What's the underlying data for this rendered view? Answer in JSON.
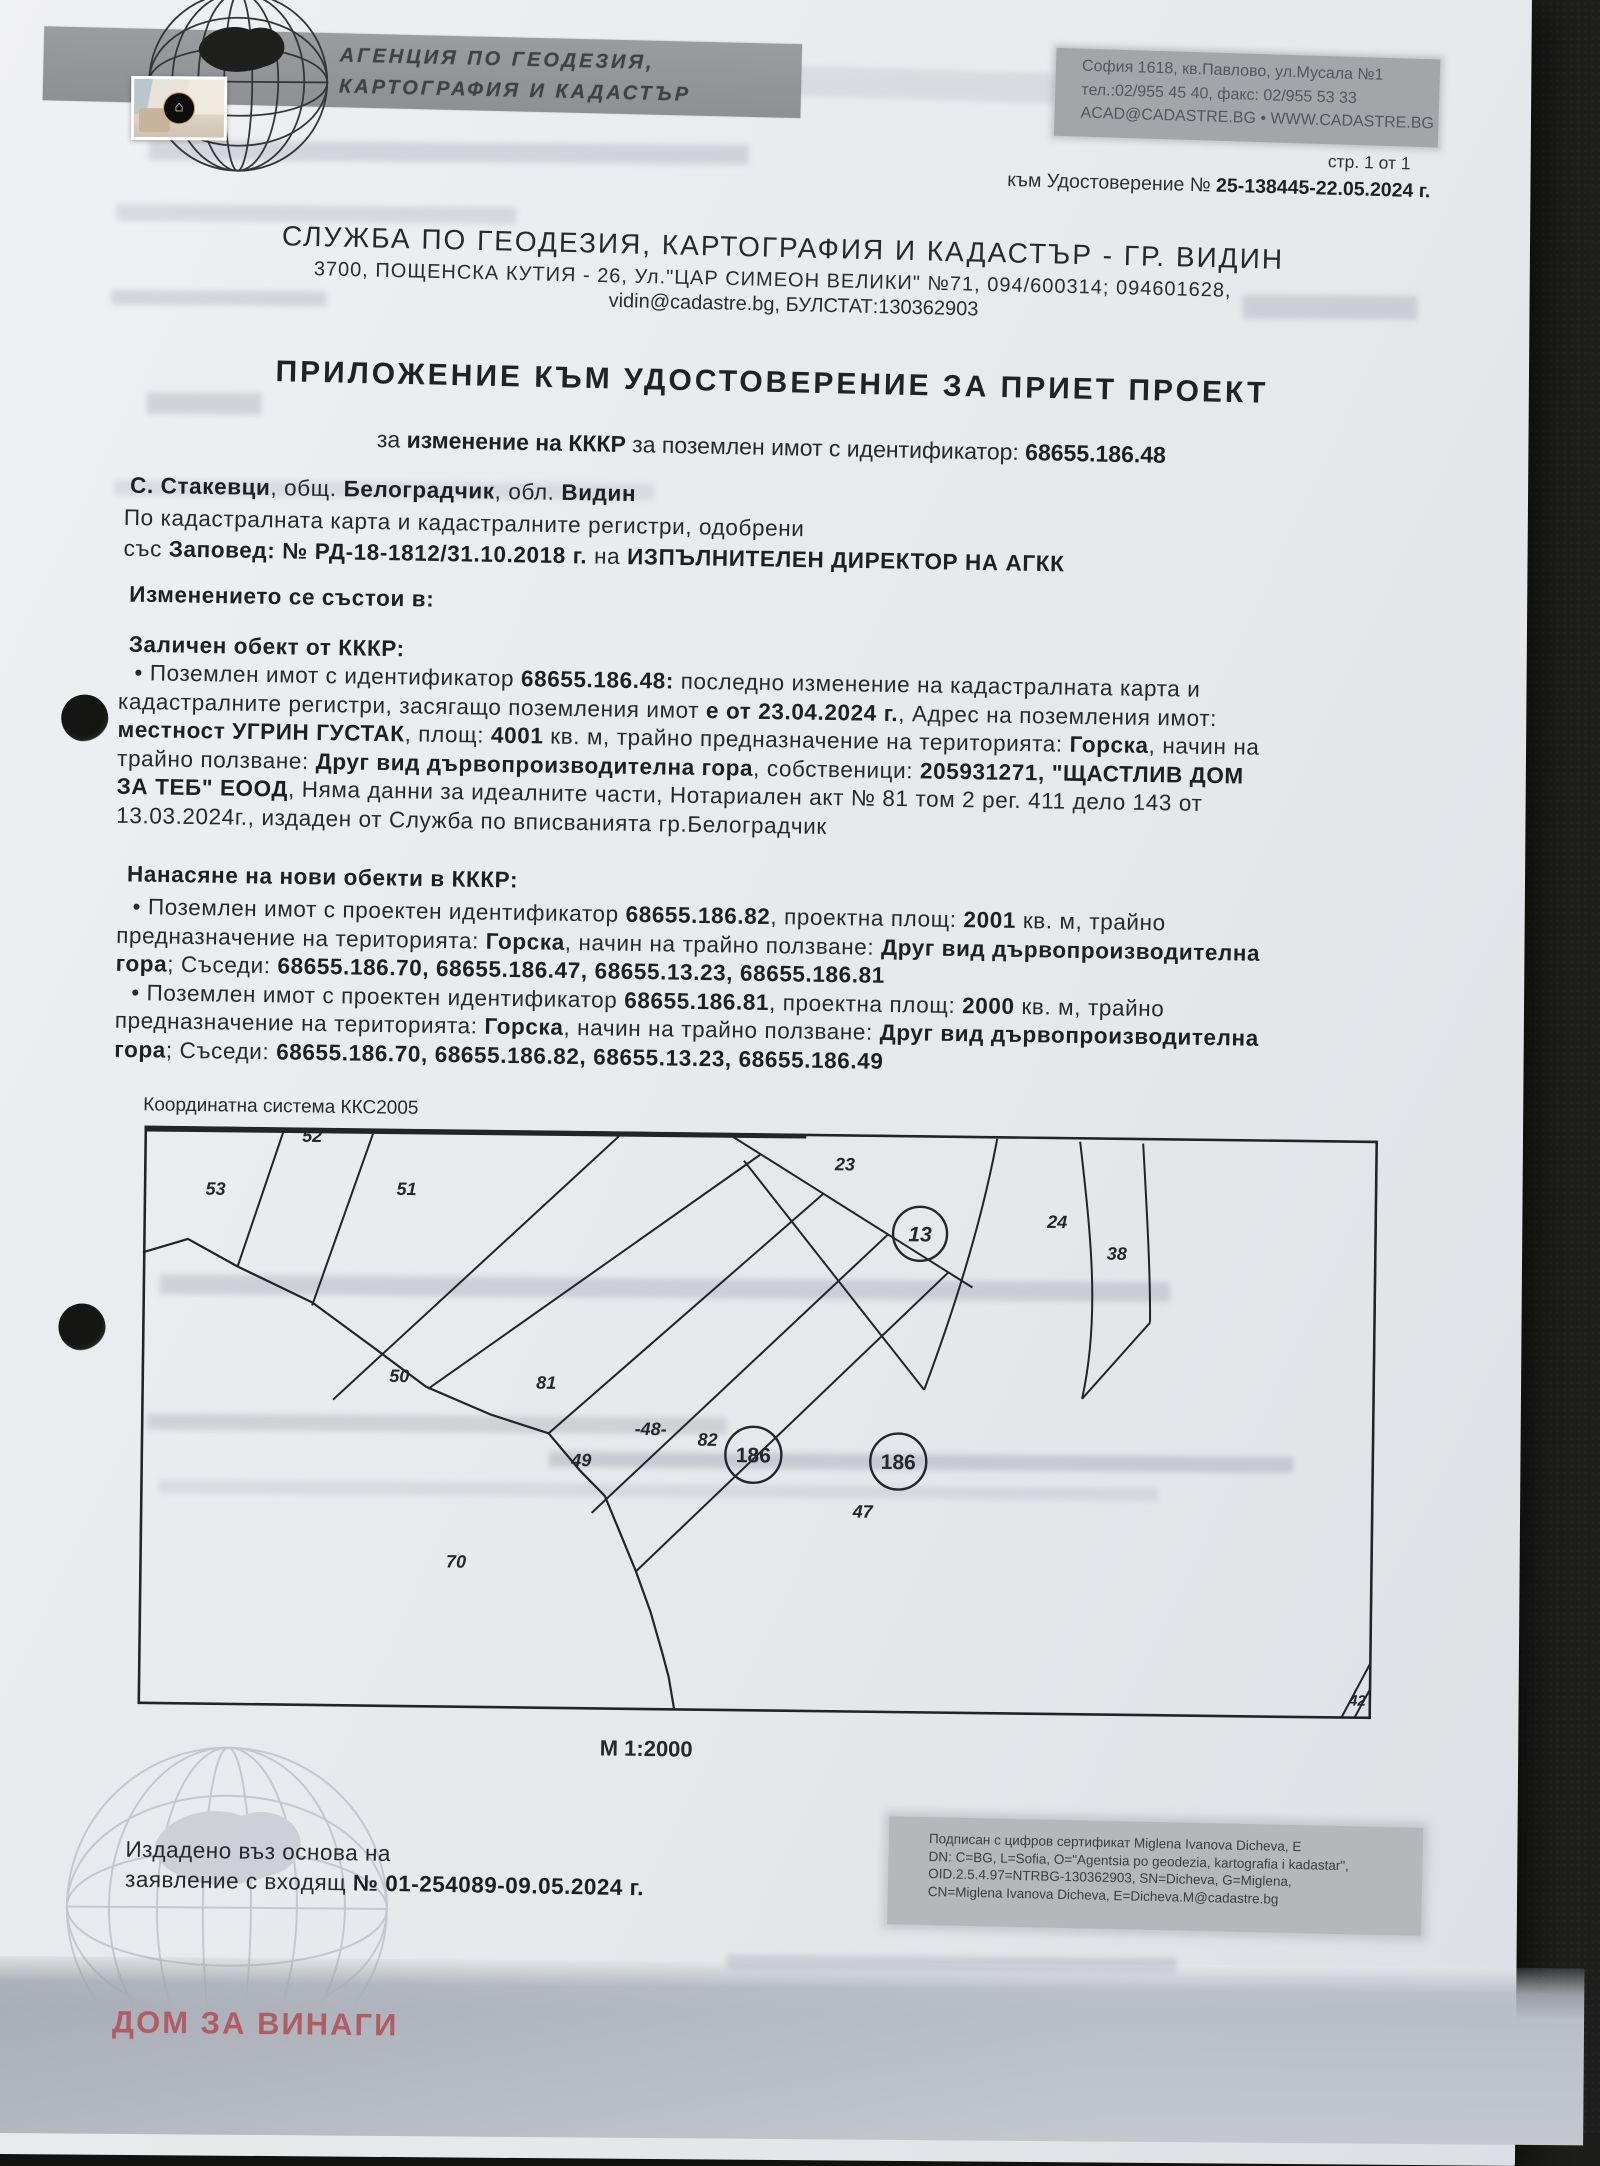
{
  "meta": {
    "page_note": "стр. 1 от 1",
    "cert_ref_label": "към Удостоверение № ",
    "cert_ref_number": "25-138445-22.05.2024 г."
  },
  "agency": {
    "name_line1": "АГЕНЦИЯ ПО ГЕОДЕЗИЯ,",
    "name_line2": "КАРТОГРАФИЯ И КАДАСТЪР",
    "hq_address": "София 1618, кв.Павлово, ул.Мусала №1",
    "hq_phone": "тел.:02/955 45 40, факс: 02/955 53 33",
    "hq_web": "ACAD@CADASTRE.BG • WWW.CADASTRE.BG",
    "logo_icon": "globe-with-bulgaria-map",
    "thumb_logo_icon": "house-in-hands"
  },
  "office": {
    "name": "СЛУЖБА ПО ГЕОДЕЗИЯ, КАРТОГРАФИЯ И КАДАСТЪР - ГР. ВИДИН",
    "address": "3700, ПОЩЕНСКА КУТИЯ - 26, Ул.\"ЦАР СИМЕОН ВЕЛИКИ\" №71, 094/600314; 094601628,",
    "contact": "vidin@cadastre.bg, БУЛСТАТ:130362903"
  },
  "title": "ПРИЛОЖЕНИЕ КЪМ УДОСТОВЕРЕНИЕ ЗА ПРИЕТ ПРОЕКТ",
  "lines": {
    "subtitle": [
      [
        "за ",
        0
      ],
      [
        "изменение на КККР",
        1
      ],
      [
        " за поземлен имот с идентификатор: ",
        0
      ],
      [
        "68655.186.48",
        1
      ]
    ],
    "location": [
      [
        "С. Стакевци",
        1
      ],
      [
        ", общ. ",
        0
      ],
      [
        "Белоградчик",
        1
      ],
      [
        ", обл. ",
        0
      ],
      [
        "Видин",
        1
      ]
    ],
    "approved1": [
      [
        "По кадастралната карта и кадастралните регистри, одобрени",
        0
      ]
    ],
    "approved2": [
      [
        "със ",
        0
      ],
      [
        "Заповед: № РД-18-1812/31.10.2018 г.",
        1
      ],
      [
        " на ",
        0
      ],
      [
        "ИЗПЪЛНИТЕЛЕН ДИРЕКТОР НА АГКК",
        1
      ]
    ],
    "issue1": [
      [
        "Издадено въз основа на",
        0
      ]
    ],
    "issue2": [
      [
        "заявление с входящ ",
        0
      ],
      [
        "№ 01-254089-09.05.2024 г.",
        1
      ]
    ]
  },
  "sections": {
    "change_heading": "Изменението се състои в:",
    "deleted_heading": "Заличен обект от КККР:",
    "deleted_lines": [
      [
        [
          "• Поземлен имот с идентификатор ",
          0
        ],
        [
          "68655.186.48:",
          1
        ],
        [
          " последно изменение на кадастралната карта и",
          0
        ]
      ],
      [
        [
          "кадастралните регистри, засягащо поземления имот ",
          0
        ],
        [
          "е от 23.04.2024 г.",
          1
        ],
        [
          ", Адрес на поземления имот:",
          0
        ]
      ],
      [
        [
          "местност УГРИН ГУСТАК",
          1
        ],
        [
          ", площ: ",
          0
        ],
        [
          "4001",
          1
        ],
        [
          " кв. м, трайно предназначение на територията: ",
          0
        ],
        [
          "Горска",
          1
        ],
        [
          ", начин на",
          0
        ]
      ],
      [
        [
          "трайно ползване: ",
          0
        ],
        [
          "Друг вид дървопроизводителна гора",
          1
        ],
        [
          ", собственици: ",
          0
        ],
        [
          "205931271, \"ЩАСТЛИВ ДОМ",
          1
        ]
      ],
      [
        [
          "ЗА ТЕБ\" ЕООД",
          1
        ],
        [
          ", Няма данни за идеалните части, Нотариален акт № 81 том 2 рег. 411 дело 143 от",
          0
        ]
      ],
      [
        [
          "13.03.2024г., издаден от Служба по вписванията гр.Белоградчик",
          0
        ]
      ]
    ],
    "new_heading": "Нанасяне на нови обекти в КККР:",
    "new_lines": [
      [
        [
          "• Поземлен имот  с проектен идентификатор ",
          0
        ],
        [
          "68655.186.82",
          1
        ],
        [
          ", проектна площ: ",
          0
        ],
        [
          "2001",
          1
        ],
        [
          " кв. м, трайно",
          0
        ]
      ],
      [
        [
          "предназначение на територията: ",
          0
        ],
        [
          "Горска",
          1
        ],
        [
          ", начин на трайно ползване: ",
          0
        ],
        [
          "Друг вид дървопроизводителна",
          1
        ]
      ],
      [
        [
          "гора",
          1
        ],
        [
          "; Съседи:  ",
          0
        ],
        [
          "68655.186.70, 68655.186.47, 68655.13.23, 68655.186.81",
          1
        ]
      ],
      [
        [
          "• Поземлен имот  с проектен идентификатор ",
          0
        ],
        [
          "68655.186.81",
          1
        ],
        [
          ", проектна площ: ",
          0
        ],
        [
          "2000",
          1
        ],
        [
          " кв. м, трайно",
          0
        ]
      ],
      [
        [
          "предназначение на територията: ",
          0
        ],
        [
          "Горска",
          1
        ],
        [
          ", начин на трайно ползване: ",
          0
        ],
        [
          "Друг вид дървопроизводителна",
          1
        ]
      ],
      [
        [
          "гора",
          1
        ],
        [
          "; Съседи:  ",
          0
        ],
        [
          "68655.186.70, 68655.186.82, 68655.13.23, 68655.186.49",
          1
        ]
      ]
    ]
  },
  "map": {
    "crs": "Координатна система ККС2005",
    "scale": "М 1:2000",
    "labels": [
      {
        "t": "52",
        "x": 168,
        "y": 8,
        "fs": 18,
        "it": 1
      },
      {
        "t": "53",
        "x": 72,
        "y": 62,
        "fs": 18,
        "it": 1
      },
      {
        "t": "51",
        "x": 263,
        "y": 60,
        "fs": 18,
        "it": 1
      },
      {
        "t": "23",
        "x": 701,
        "y": 30,
        "fs": 18,
        "it": 1
      },
      {
        "t": "13",
        "x": 777,
        "y": 99,
        "fs": 21,
        "it": 1,
        "c": 27
      },
      {
        "t": "24",
        "x": 914,
        "y": 85,
        "fs": 18,
        "it": 1
      },
      {
        "t": "38",
        "x": 974,
        "y": 116,
        "fs": 18,
        "it": 1
      },
      {
        "t": "50",
        "x": 258,
        "y": 247,
        "fs": 18,
        "it": 1
      },
      {
        "t": "81",
        "x": 405,
        "y": 252,
        "fs": 18,
        "it": 1
      },
      {
        "t": "-48-",
        "x": 510,
        "y": 297,
        "fs": 18,
        "it": 1
      },
      {
        "t": "82",
        "x": 567,
        "y": 307,
        "fs": 18,
        "it": 1
      },
      {
        "t": "49",
        "x": 441,
        "y": 329,
        "fs": 18,
        "it": 1
      },
      {
        "t": "186",
        "x": 613,
        "y": 322,
        "fs": 21,
        "it": 0,
        "c": 28
      },
      {
        "t": "186",
        "x": 758,
        "y": 327,
        "fs": 21,
        "it": 0,
        "c": 28
      },
      {
        "t": "47",
        "x": 723,
        "y": 377,
        "fs": 18,
        "it": 1
      },
      {
        "t": "70",
        "x": 317,
        "y": 432,
        "fs": 18,
        "it": 1
      },
      {
        "t": "42",
        "x": 1220,
        "y": 560,
        "fs": 15,
        "it": 1
      }
    ]
  },
  "footer": {
    "signature_lines": [
      "Подписан с цифров сертификат Miglena Ivanova Dicheva, E",
      "DN: C=BG, L=Sofia, O=\"Agentsia po geodezia, kartografia i kadastar\",",
      "OID.2.5.4.97=NTRBG-130362903, SN=Dicheva, G=Miglena,",
      "CN=Miglena Ivanova Dicheva, E=Dicheva.M@cadastre.bg"
    ]
  },
  "watermark": {
    "brand": "ДОМ ЗА ВИНАГИ"
  },
  "colors": {
    "paper": "#e9ebee",
    "banner_gray": "#97989b",
    "contact_block_gray": "#a3a5a9",
    "signature_block_gray": "#b5b7bb",
    "ink": "#26282c",
    "map_stroke": "#232428",
    "brand_red": "#b2565f",
    "bottom_strip": "#b4bac4",
    "background_dark": "#1e1e1c"
  }
}
